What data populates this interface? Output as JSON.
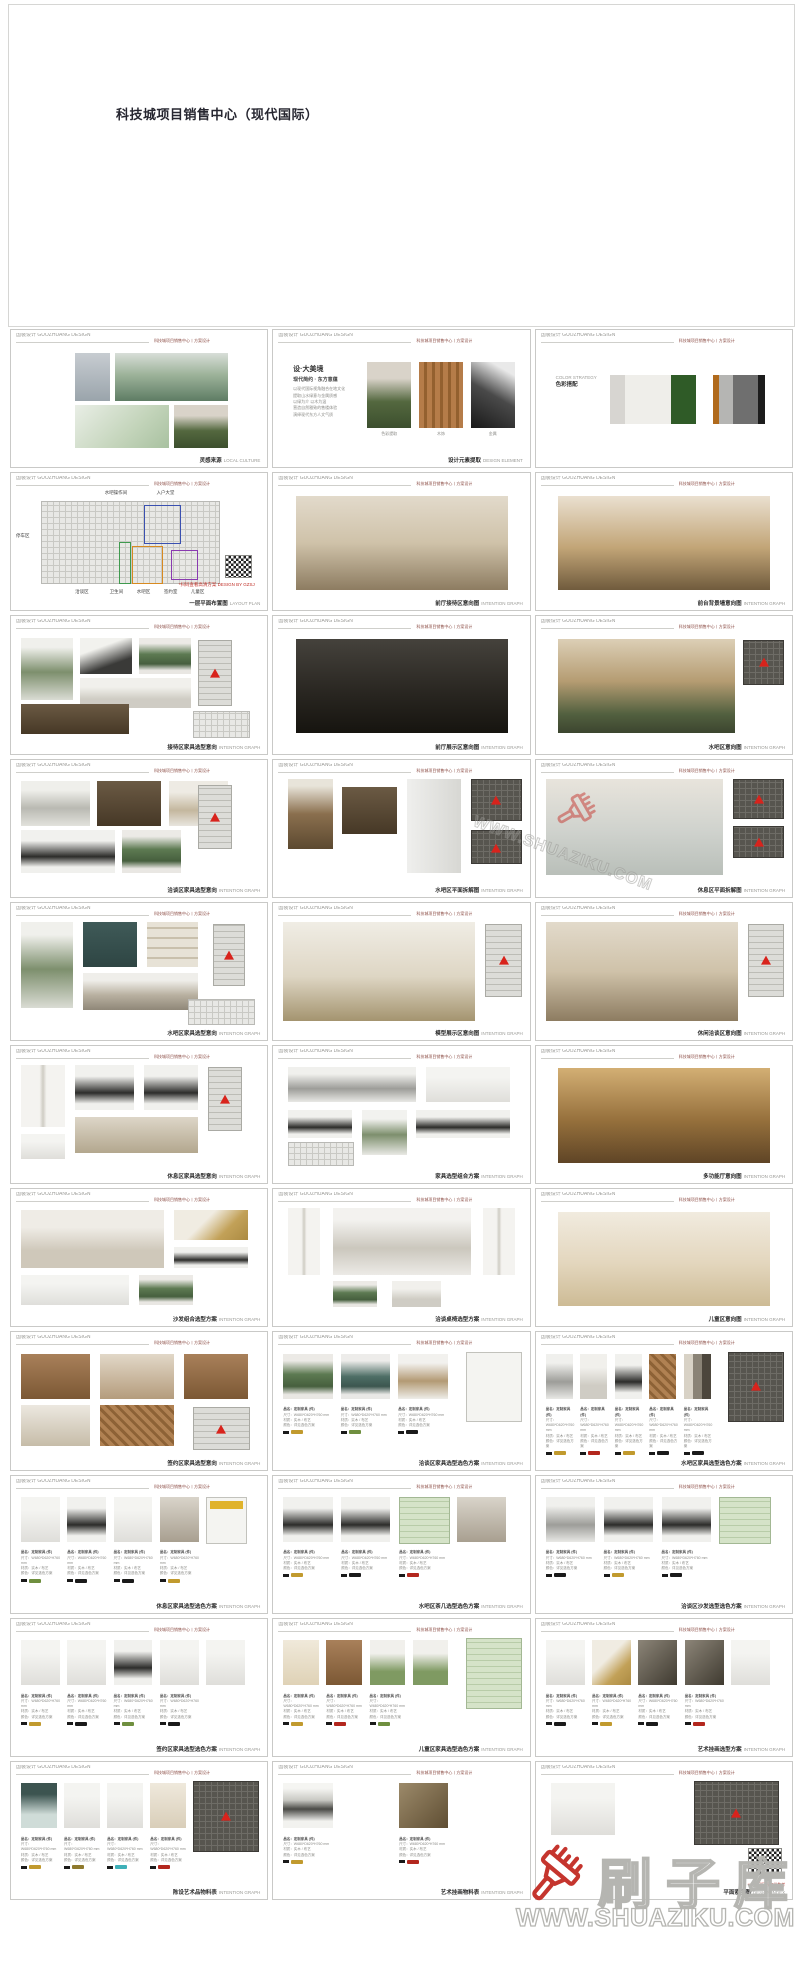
{
  "title": "科技城项目销售中心（现代国际）",
  "header": {
    "left": "国装设计 GUOZHUANG DESIGN",
    "right": "科技城项目销售中心丨方案设计"
  },
  "watermark": {
    "brand": "刷子库",
    "url": "WWW.SHUAZIKU.COM",
    "brush_color": "#c5352e",
    "outline_color": "#b5b5b1"
  },
  "spec_lines": [
    "品名：定制家具 (件)",
    "尺寸：W680*D620*H760 mm",
    "材质：实木 / 布艺",
    "颜色：详见选色方案"
  ],
  "concept": {
    "title": "设·大美境",
    "sub": "现代简约 · 东方意蕴",
    "lines": [
      "以现代国际视角融合在地文化",
      "提取山水绿意与金属质感",
      "以绿为介 以木为温",
      "营造自然雅致的售楼体验",
      "演绎现代东方人文气质"
    ],
    "img_labels": [
      "色彩提取",
      "木饰",
      "金属"
    ]
  },
  "palette": {
    "label_en": "COLOR STRATEGY",
    "label_cn": "色彩搭配",
    "groups": [
      [
        {
          "c": "#d7d5d1",
          "w": 6
        },
        {
          "c": "#efeeea",
          "w": 19
        },
        {
          "c": "#2f5b27",
          "w": 10
        }
      ],
      [
        {
          "c": "#b06a1c",
          "w": 2.5
        },
        {
          "c": "#b5b5b3",
          "w": 5.5
        },
        {
          "c": "#6f6f6f",
          "w": 10
        },
        {
          "c": "#1c1c1c",
          "w": 3
        }
      ]
    ]
  },
  "floorplan": {
    "callouts_top": [
      {
        "t": "水吧操作间",
        "x": 36
      },
      {
        "t": "入户大堂",
        "x": 57
      }
    ],
    "callout_left": {
      "t": "停车区",
      "y": 40
    },
    "callouts_bottom": [
      {
        "t": "洽谈区",
        "x": 24
      },
      {
        "t": "卫生间",
        "x": 38
      },
      {
        "t": "水吧区",
        "x": 49
      },
      {
        "t": "签约室",
        "x": 60
      },
      {
        "t": "儿童区",
        "x": 71
      }
    ],
    "zones": [
      {
        "c": "#3a50b0",
        "x": 52,
        "y": 14,
        "w": 14,
        "h": 34
      },
      {
        "c": "#3f9a4e",
        "x": 42,
        "y": 48,
        "w": 4,
        "h": 38
      },
      {
        "c": "#d88a20",
        "x": 47,
        "y": 52,
        "w": 12,
        "h": 34
      },
      {
        "c": "#8a3ab0",
        "x": 63,
        "y": 56,
        "w": 10,
        "h": 26
      }
    ],
    "note": "*扫码查看高清方案 DESIGN BY GZSJ"
  },
  "qr_note": "*本方案图纸仅供参考",
  "slides": [
    {
      "r": 1,
      "c": 0,
      "t": "blocks",
      "cap": "灵感来源",
      "en": "LOCAL CULTURE",
      "blocks": [
        [
          "tower",
          24,
          6,
          14,
          44
        ],
        [
          "mountain",
          40,
          6,
          46,
          44
        ],
        [
          "masterplan",
          24,
          54,
          38,
          40
        ],
        [
          "portrait",
          64,
          54,
          22,
          40
        ]
      ]
    },
    {
      "r": 1,
      "c": 1,
      "t": "concept",
      "cap": "设计元素提取",
      "en": "DESIGN ELEMENT"
    },
    {
      "r": 1,
      "c": 2,
      "t": "palette",
      "cap": "",
      "en": ""
    },
    {
      "r": 2,
      "c": 0,
      "t": "floorplan",
      "cap": "一层平面布置图",
      "en": "LAYOUT PLAN"
    },
    {
      "r": 2,
      "c": 1,
      "t": "blocks",
      "cap": "前厅接待区意向图",
      "en": "INTENTION GRAPH",
      "blocks": [
        [
          "renderlight",
          7,
          5,
          86,
          88
        ]
      ]
    },
    {
      "r": 2,
      "c": 2,
      "t": "blocks",
      "cap": "前台背景墙意向图",
      "en": "INTENTION GRAPH",
      "blocks": [
        [
          "renderwarm",
          7,
          5,
          86,
          88
        ]
      ]
    },
    {
      "r": 3,
      "c": 0,
      "t": "blocks",
      "cap": "接待区家具选型意向",
      "en": "INTENTION GRAPH",
      "blocks": [
        [
          "plant",
          2,
          4,
          21,
          58
        ],
        [
          "inkart",
          26,
          4,
          21,
          34
        ],
        [
          "greenchair",
          50,
          4,
          21,
          34
        ],
        [
          "marbletable",
          26,
          42,
          45,
          28
        ],
        [
          "cabinet",
          2,
          66,
          44,
          28
        ],
        [
          "plankey",
          74,
          6,
          13,
          60
        ],
        [
          "plan",
          72,
          72,
          22,
          24
        ]
      ]
    },
    {
      "r": 3,
      "c": 1,
      "t": "blocks",
      "cap": "前厅展示区意向图",
      "en": "INTENTION GRAPH",
      "blocks": [
        [
          "renderdark",
          7,
          5,
          86,
          88
        ]
      ]
    },
    {
      "r": 3,
      "c": 2,
      "t": "blocks",
      "cap": "水吧区意向图",
      "en": "INTENTION GRAPH",
      "blocks": [
        [
          "waterbar",
          7,
          5,
          72,
          88
        ],
        [
          "darkplan",
          82,
          6,
          16,
          40
        ]
      ]
    },
    {
      "r": 4,
      "c": 0,
      "t": "blocks",
      "cap": "洽谈区家具选型意向",
      "en": "INTENTION GRAPH",
      "blocks": [
        [
          "sculpt",
          2,
          4,
          28,
          42
        ],
        [
          "cabinet",
          33,
          4,
          26,
          42
        ],
        [
          "armchair",
          62,
          4,
          24,
          42
        ],
        [
          "blacktable",
          2,
          50,
          38,
          40
        ],
        [
          "greenchair",
          43,
          50,
          24,
          40
        ],
        [
          "plankey",
          74,
          8,
          13,
          58
        ]
      ]
    },
    {
      "r": 4,
      "c": 1,
      "t": "blocks",
      "cap": "水吧区平面拆解图",
      "en": "INTENTION GRAPH",
      "blocks": [
        [
          "bronze",
          4,
          2,
          18,
          66
        ],
        [
          "cabinet",
          26,
          10,
          22,
          44
        ],
        [
          "fridge",
          52,
          2,
          22,
          88
        ],
        [
          "darkplan",
          78,
          2,
          20,
          38
        ],
        [
          "darkplan",
          78,
          50,
          20,
          30
        ]
      ]
    },
    {
      "r": 4,
      "c": 2,
      "t": "blocks",
      "cap": "休息区平面拆解图",
      "en": "INTENTION GRAPH",
      "blocks": [
        [
          "renderlight2",
          2,
          2,
          72,
          90
        ],
        [
          "darkplan",
          78,
          2,
          20,
          36
        ],
        [
          "darkplan",
          78,
          46,
          20,
          28
        ]
      ]
    },
    {
      "r": 5,
      "c": 0,
      "t": "blocks",
      "cap": "水吧区家具选型意向",
      "en": "INTENTION GRAPH",
      "blocks": [
        [
          "plant",
          2,
          2,
          21,
          80
        ],
        [
          "tealart",
          27,
          2,
          22,
          42
        ],
        [
          "shelf",
          53,
          2,
          21,
          42
        ],
        [
          "stonetable",
          27,
          50,
          47,
          34
        ],
        [
          "plankey",
          80,
          4,
          12,
          56
        ],
        [
          "plan",
          70,
          74,
          26,
          22
        ]
      ]
    },
    {
      "r": 5,
      "c": 1,
      "t": "blocks",
      "cap": "模型展示区意向图",
      "en": "INTENTION GRAPH",
      "blocks": [
        [
          "hallrender",
          2,
          2,
          78,
          92
        ],
        [
          "plankey",
          84,
          4,
          14,
          66
        ]
      ]
    },
    {
      "r": 5,
      "c": 2,
      "t": "blocks",
      "cap": "休闲洽谈区意向图",
      "en": "INTENTION GRAPH",
      "blocks": [
        [
          "renderlight",
          2,
          2,
          78,
          92
        ],
        [
          "plankey",
          84,
          4,
          14,
          66
        ]
      ]
    },
    {
      "r": 6,
      "c": 0,
      "t": "blocks",
      "cap": "休息区家具选型意向",
      "en": "INTENTION GRAPH",
      "blocks": [
        [
          "floorlamp",
          2,
          2,
          18,
          58
        ],
        [
          "blacktable",
          24,
          2,
          24,
          42
        ],
        [
          "blackround",
          52,
          2,
          22,
          42
        ],
        [
          "displaycab",
          24,
          50,
          50,
          34
        ],
        [
          "stool",
          2,
          66,
          18,
          24
        ],
        [
          "plankey",
          78,
          4,
          13,
          58
        ]
      ]
    },
    {
      "r": 6,
      "c": 1,
      "t": "blocks",
      "cap": "家具选型组合方案",
      "en": "INTENTION GRAPH",
      "blocks": [
        [
          "sofagrey",
          4,
          4,
          52,
          32
        ],
        [
          "daybed",
          60,
          4,
          34,
          32
        ],
        [
          "blacktable",
          4,
          44,
          26,
          26
        ],
        [
          "bonsai",
          34,
          44,
          18,
          42
        ],
        [
          "blackround",
          56,
          44,
          38,
          26
        ],
        [
          "plan",
          4,
          74,
          26,
          20
        ]
      ]
    },
    {
      "r": 6,
      "c": 2,
      "t": "blocks",
      "cap": "多功能厅意向图",
      "en": "INTENTION GRAPH",
      "blocks": [
        [
          "banquet",
          7,
          5,
          86,
          88
        ]
      ]
    },
    {
      "r": 7,
      "c": 0,
      "t": "blocks",
      "cap": "沙发组合选型方案",
      "en": "INTENTION GRAPH",
      "blocks": [
        [
          "sofaset",
          2,
          4,
          58,
          54
        ],
        [
          "goldart",
          64,
          4,
          30,
          28
        ],
        [
          "blacktable",
          64,
          38,
          30,
          20
        ],
        [
          "daybed",
          2,
          64,
          44,
          28
        ],
        [
          "greenchair",
          50,
          64,
          22,
          28
        ]
      ]
    },
    {
      "r": 7,
      "c": 1,
      "t": "blocks",
      "cap": "洽谈桌椅选型方案",
      "en": "INTENTION GRAPH",
      "blocks": [
        [
          "floorlamp",
          4,
          2,
          13,
          62
        ],
        [
          "diningset",
          22,
          2,
          56,
          62
        ],
        [
          "floorlamp",
          83,
          2,
          13,
          62
        ],
        [
          "greenchair",
          22,
          70,
          18,
          24
        ],
        [
          "marbletable",
          46,
          70,
          20,
          24
        ]
      ]
    },
    {
      "r": 7,
      "c": 2,
      "t": "blocks",
      "cap": "儿童区意向图",
      "en": "INTENTION GRAPH",
      "blocks": [
        [
          "kidsrender",
          7,
          5,
          86,
          88
        ]
      ]
    },
    {
      "r": 8,
      "c": 0,
      "t": "blocks",
      "cap": "签约区家具选型意向",
      "en": "INTENTION GRAPH",
      "blocks": [
        [
          "woodcab",
          2,
          4,
          28,
          42
        ],
        [
          "teaset",
          34,
          4,
          30,
          42
        ],
        [
          "woodcab",
          68,
          4,
          26,
          42
        ],
        [
          "kettle",
          2,
          52,
          28,
          38
        ],
        [
          "wooddetail",
          34,
          52,
          30,
          38
        ],
        [
          "plankey",
          72,
          54,
          22,
          38
        ]
      ]
    },
    {
      "r": 8,
      "c": 1,
      "t": "board",
      "cap": "洽谈区家具选型选色方案",
      "en": "INTENTION GRAPH",
      "prods": [
        "greenchair",
        "tealchair",
        "birdtable"
      ],
      "tags": [
        "#c19a2e",
        "#6f8f3f",
        "#1a1a1a"
      ],
      "right": "whiteplan"
    },
    {
      "r": 8,
      "c": 2,
      "t": "board",
      "cap": "水吧区家具选型选色方案",
      "en": "INTENTION GRAPH",
      "prods": [
        "loungegrey",
        "marbletable",
        "blackround",
        "wooddetail",
        "collage"
      ],
      "tags": [
        "#c19a2e",
        "#b3271e",
        "#c19a2e",
        "#1a1a1a",
        "#1a1a1a"
      ],
      "right": "darkplan"
    },
    {
      "r": 9,
      "c": 0,
      "t": "board",
      "cap": "休息区家具选型选色方案",
      "en": "INTENTION GRAPH",
      "prods": [
        "whitechair",
        "blacknest",
        "sidetable",
        "interior",
        "yellowplan"
      ],
      "tags": [
        "#6f8f3f",
        "#1a1a1a",
        "#1a1a1a",
        "#c19a2e"
      ],
      "right": null
    },
    {
      "r": 9,
      "c": 1,
      "t": "board",
      "cap": "水吧区茶几选型选色方案",
      "en": "INTENTION GRAPH",
      "prods": [
        "ovaltable",
        "ringtable",
        "greenplan",
        "interior"
      ],
      "tags": [
        "#c19a2e",
        "#1a1a1a",
        "#b3271e"
      ],
      "right": null
    },
    {
      "r": 9,
      "c": 2,
      "t": "board",
      "cap": "洽谈区沙发选型选色方案",
      "en": "INTENTION GRAPH",
      "prods": [
        "sofagrey",
        "blacknest",
        "blackround",
        "greenplan"
      ],
      "tags": [
        "#1a1a1a",
        "#c19a2e",
        "#1a1a1a"
      ],
      "right": null
    },
    {
      "r": 10,
      "c": 0,
      "t": "board",
      "cap": "签约区家具选型选色方案",
      "en": "INTENTION GRAPH",
      "prods": [
        "daybed",
        "daybed",
        "ovaltable",
        "whitechair",
        "stool"
      ],
      "tags": [
        "#c19a2e",
        "#1a1a1a",
        "#6f8f3f",
        "#1a1a1a"
      ],
      "right": null
    },
    {
      "r": 10,
      "c": 1,
      "t": "board",
      "cap": "儿童区家具选型选色方案",
      "en": "INTENTION GRAPH",
      "prods": [
        "playhouse",
        "woodcab",
        "turtle",
        "turtle"
      ],
      "tags": [
        "#c19a2e",
        "#b3271e",
        "#6f8f3f"
      ],
      "right": "greenplan"
    },
    {
      "r": 10,
      "c": 2,
      "t": "board",
      "cap": "艺术挂画选型方案",
      "en": "INTENTION GRAPH",
      "prods": [
        "artwhite",
        "goldart",
        "artdark",
        "artdark",
        "artwhite"
      ],
      "tags": [
        "#1a1a1a",
        "#c19a2e",
        "#1a1a1a",
        "#b3271e"
      ],
      "right": null
    },
    {
      "r": 11,
      "c": 0,
      "t": "board",
      "cap": "陈设艺术品物料表",
      "en": "INTENTION GRAPH",
      "prods": [
        "glassrabbit",
        "sconce",
        "vase",
        "glasslamp"
      ],
      "tags": [
        "#c19a2e",
        "#8f7a2e",
        "#3fb0b8",
        "#b3271e"
      ],
      "right": "bigplan"
    },
    {
      "r": 11,
      "c": 1,
      "t": "board",
      "cap": "艺术挂画物料表",
      "en": "INTENTION GRAPH",
      "prods": [
        "inkscroll",
        "bronzeart"
      ],
      "tags": [
        "#c19a2e",
        "#b3271e"
      ],
      "right": null
    },
    {
      "r": 11,
      "c": 2,
      "t": "blocks",
      "cap": "平面索引图",
      "en": "DESIGN INDEX",
      "note": true,
      "blocks": [
        [
          "artwhite",
          4,
          4,
          26,
          48
        ],
        [
          "darkplan",
          62,
          2,
          34,
          58
        ],
        [
          "qr",
          84,
          64,
          13,
          24
        ]
      ]
    }
  ]
}
